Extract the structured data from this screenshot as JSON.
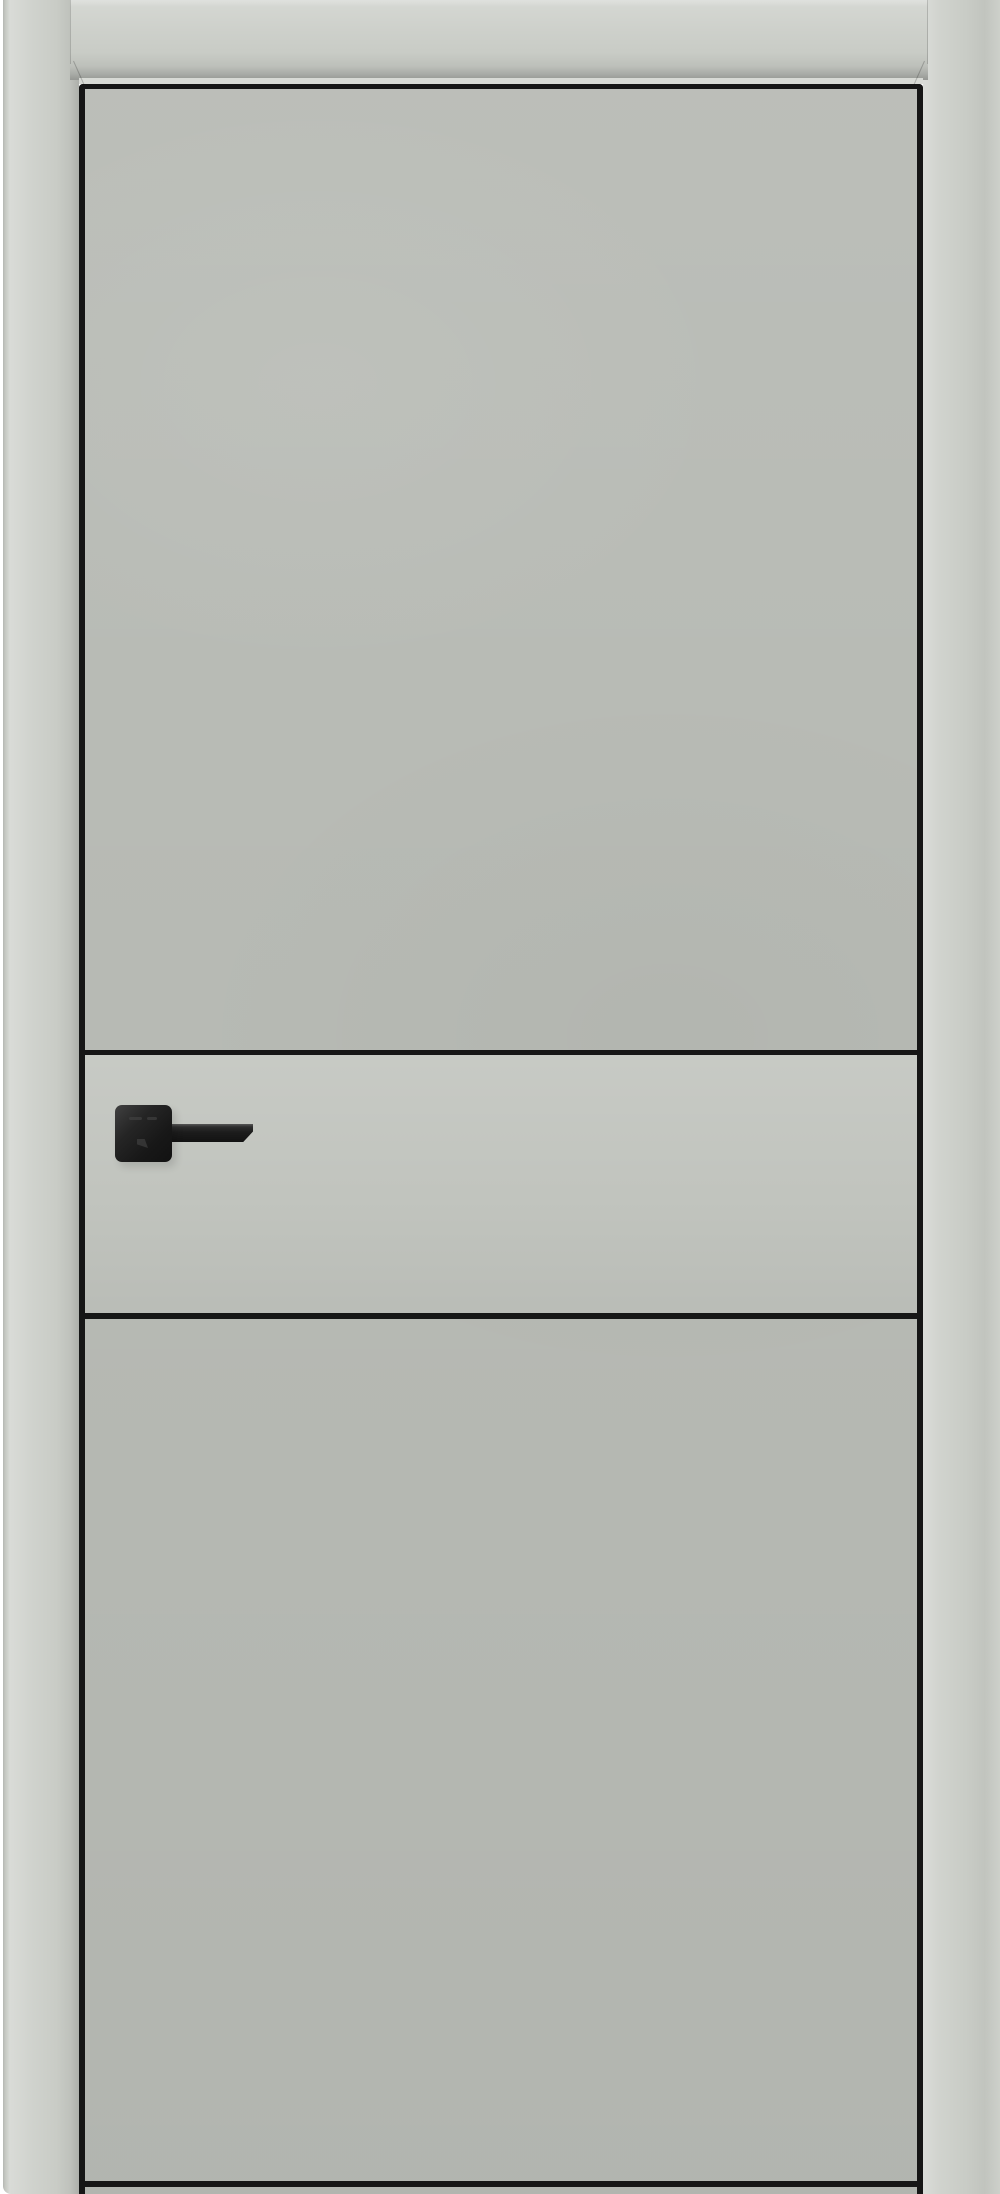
{
  "scene": {
    "type": "product-photo",
    "subject": "Modern flush interior door in matte gray finish with black aluminum edge trim, two horizontal black inlay strips forming a center band, and a matte black square-rose lever handle, shown closed inside a matching gray frame on a white background",
    "orientation": "front view, full height",
    "text_content": "none"
  },
  "palette": {
    "background": "#ffffff",
    "frame": "#c9ccc6",
    "frame_highlight": "#d8dad5",
    "frame_shadow": "#abaea8",
    "leaf": "#b8bbb5",
    "band": "#c1c4be",
    "trim": "#161616",
    "hardware": "#1c1c1c",
    "hardware_highlight": "#424242"
  }
}
